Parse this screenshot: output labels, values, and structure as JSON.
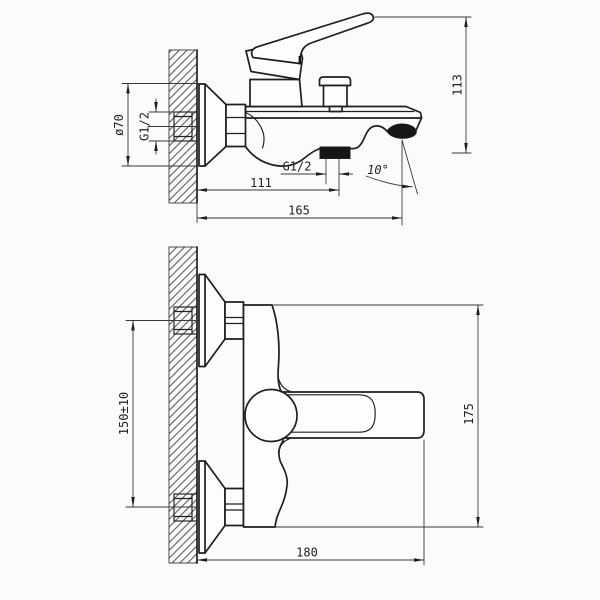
{
  "drawing": {
    "colors": {
      "background": "#fbfbfa",
      "object_line": "#1f1f1f",
      "thin_line": "#3a3a3a",
      "text": "#222222",
      "solid_fill": "#161616"
    },
    "side_view": {
      "labels": {
        "escutcheon_diameter": "ø70",
        "wall_thread": "G1/2",
        "outlet_thread": "G1/2",
        "wall_to_outlet": "111",
        "total_projection": "165",
        "overall_height": "113",
        "spout_angle": "10°"
      }
    },
    "front_view": {
      "labels": {
        "centers_distance": "150±10",
        "overall_height": "175",
        "overall_width": "180"
      }
    }
  }
}
